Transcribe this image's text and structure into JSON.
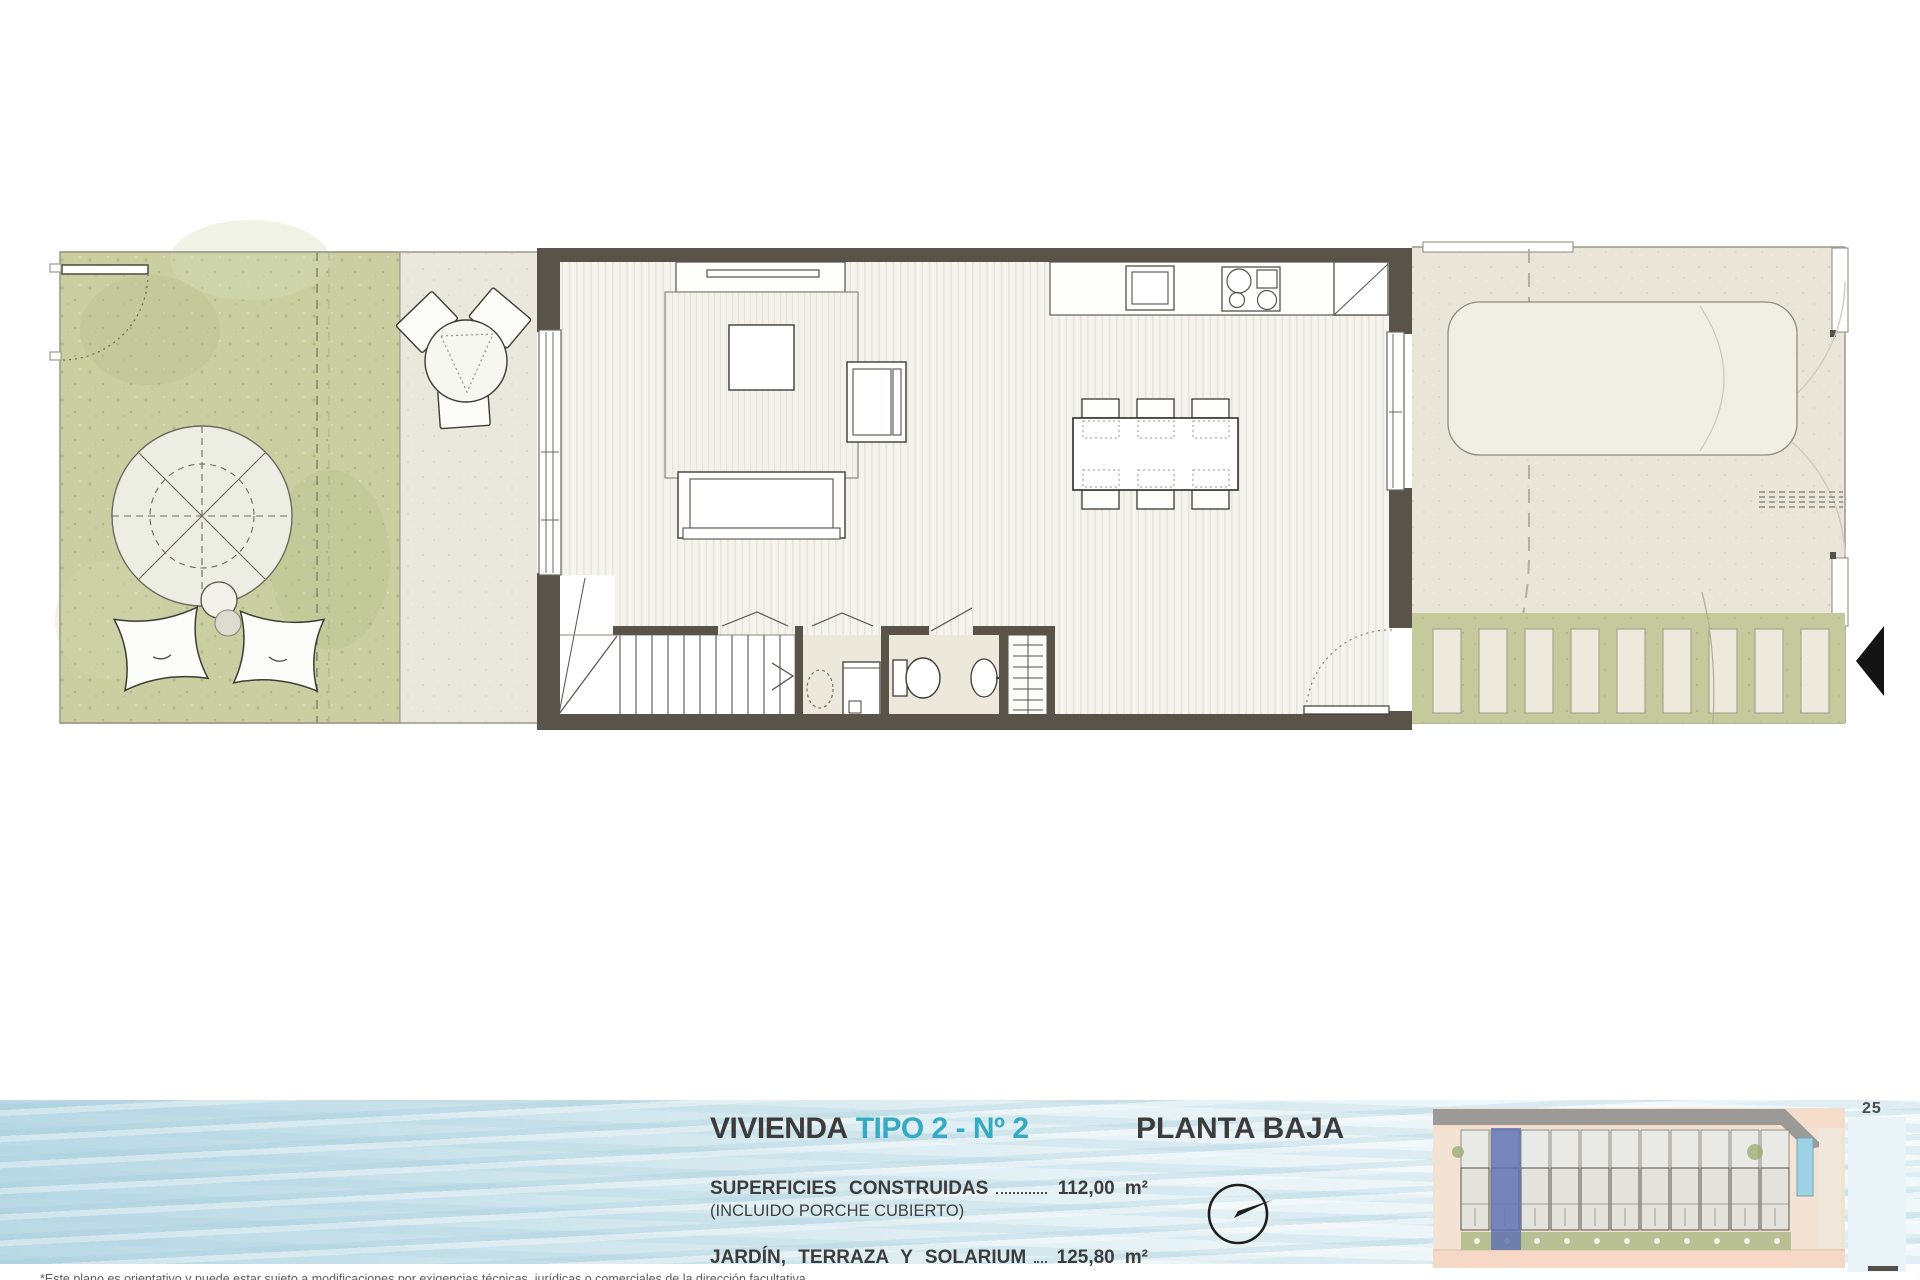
{
  "footer": {
    "title_main": "VIVIENDA",
    "title_accent": "TIPO 2 - Nº 2",
    "plan_name": "PLANTA BAJA",
    "rows": [
      {
        "label": "SUPERFICIES CONSTRUIDAS",
        "note": "(INCLUIDO PORCHE CUBIERTO)",
        "value": "112,00",
        "unit": "m²"
      },
      {
        "label": "JARDÍN, TERRAZA Y SOLARIUM",
        "value": "125,80",
        "unit": "m²"
      }
    ],
    "page_number": "25",
    "disclaimer": "*Este plano es orientativo y puede estar sujeto a modificaciones por exigencias técnicas, jurídicas o comerciales de la dirección facultativa."
  },
  "plan": {
    "dwelling_type": "TIPO 2",
    "unit_number": "2",
    "floor": "PLANTA BAJA",
    "built_area_m2": "112,00",
    "garden_terrace_solarium_m2": "125,80"
  },
  "colors": {
    "accent_teal": "#36a9c3",
    "text_dark": "#3c3c3c",
    "wall": "#5a5349",
    "garden_green": "#c9cfa1",
    "deck_green": "#c4ca9c",
    "paving": "#eae7dd",
    "terrace": "#e9e5d8",
    "water_blue": "#bedde7",
    "siteplan_highlight_blue": "#5e6fb3",
    "siteplan_pink": "#f5ddcb",
    "pool_blue": "#9ed2e2"
  }
}
